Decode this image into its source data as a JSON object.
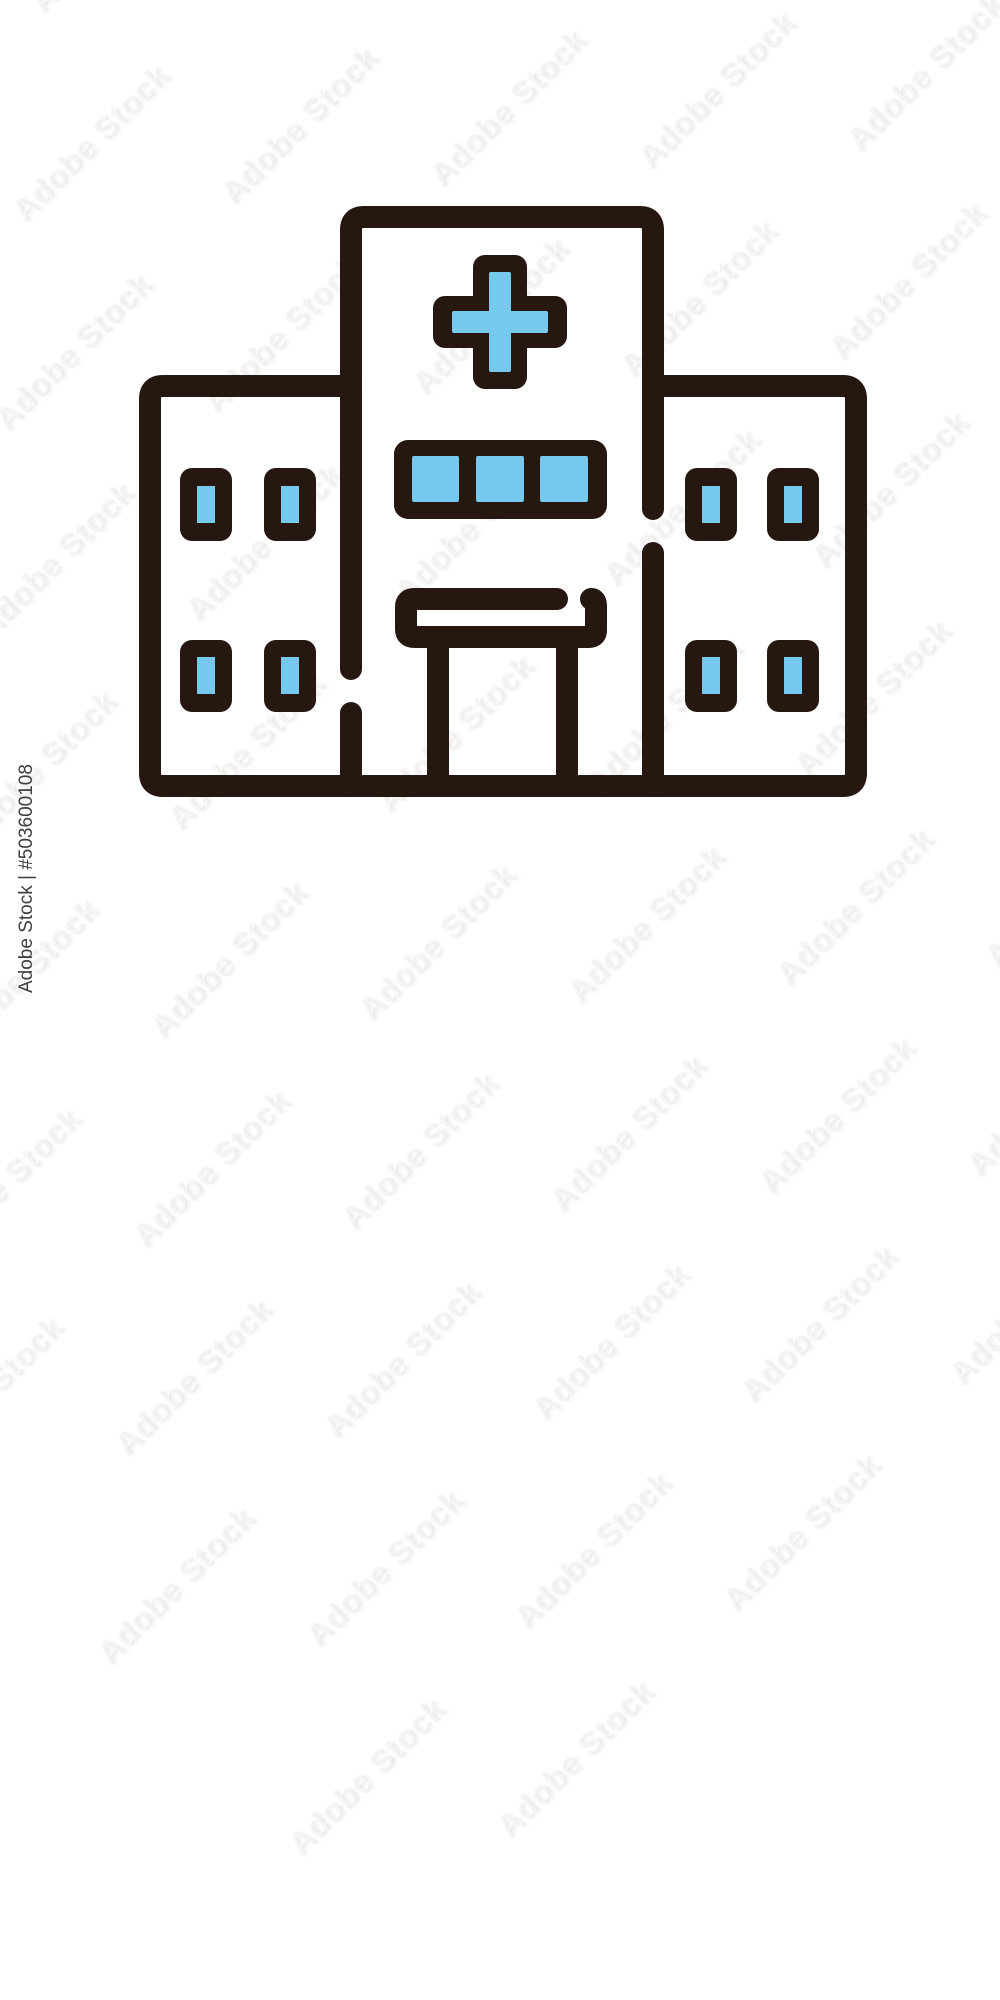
{
  "image": {
    "background_color": "#ffffff",
    "description": "Hospital building line icon with blue accent fills"
  },
  "watermark": {
    "tile_text": "Adobe Stock",
    "edge_text": "Adobe Stock | #503600108",
    "asset_number": "503600108"
  },
  "icon": {
    "name": "hospital-building",
    "outline_color": "#261711",
    "accent_color": "#76c8ed",
    "center_band_windows": 3,
    "left_wing_windows": 4,
    "right_wing_windows": 4,
    "features": [
      "medical-cross-sign",
      "window-band",
      "entrance-canopy",
      "two-pillars",
      "left-wing",
      "right-wing"
    ]
  }
}
